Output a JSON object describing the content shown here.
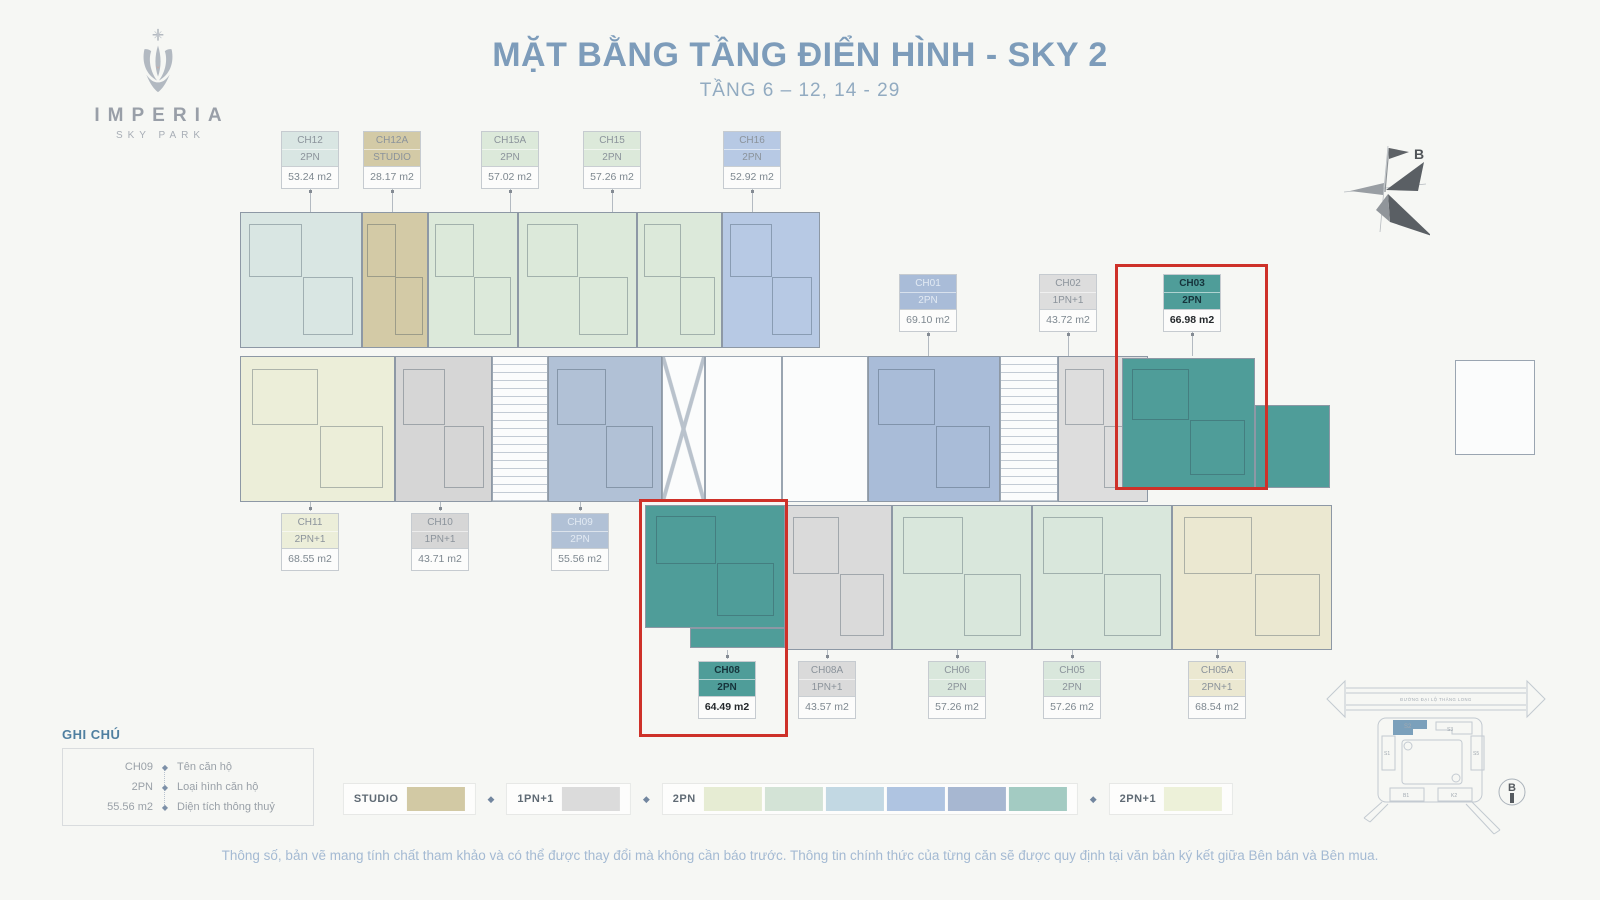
{
  "logo": {
    "title": "IMPERIA",
    "subtitle": "SKY PARK"
  },
  "header": {
    "title": "MẶT BẰNG TẦNG ĐIỂN HÌNH - SKY 2",
    "subtitle": "TẦNG 6 – 12, 14 - 29"
  },
  "compass": {
    "label": "B"
  },
  "units": [
    {
      "id": "CH12",
      "type": "2PN",
      "area": "53.24 m2",
      "color": "#d9e6e3",
      "scheme": "grey",
      "highlight": false
    },
    {
      "id": "CH12A",
      "type": "STUDIO",
      "area": "28.17 m2",
      "color": "#d3caa6",
      "scheme": "grey",
      "highlight": false
    },
    {
      "id": "CH15A",
      "type": "2PN",
      "area": "57.02 m2",
      "color": "#dce9da",
      "scheme": "grey",
      "highlight": false
    },
    {
      "id": "CH15",
      "type": "2PN",
      "area": "57.26 m2",
      "color": "#dce9da",
      "scheme": "grey",
      "highlight": false
    },
    {
      "id": "CH16",
      "type": "2PN",
      "area": "52.92 m2",
      "color": "#b7c9e4",
      "scheme": "grey",
      "highlight": false
    },
    {
      "id": "CH01",
      "type": "2PN",
      "area": "69.10 m2",
      "color": "#a9bcd8",
      "scheme": "light",
      "highlight": false
    },
    {
      "id": "CH02",
      "type": "1PN+1",
      "area": "43.72 m2",
      "color": "#dddddd",
      "scheme": "grey",
      "highlight": false
    },
    {
      "id": "CH03",
      "type": "2PN",
      "area": "66.98 m2",
      "color": "#4f9d99",
      "scheme": "dark",
      "highlight": true
    },
    {
      "id": "CH11",
      "type": "2PN+1",
      "area": "68.55 m2",
      "color": "#eceed9",
      "scheme": "grey",
      "highlight": false
    },
    {
      "id": "CH10",
      "type": "1PN+1",
      "area": "43.71 m2",
      "color": "#d6d6d6",
      "scheme": "grey",
      "highlight": false
    },
    {
      "id": "CH09",
      "type": "2PN",
      "area": "55.56 m2",
      "color": "#b1c1d6",
      "scheme": "light",
      "highlight": false
    },
    {
      "id": "CH08",
      "type": "2PN",
      "area": "64.49 m2",
      "color": "#4f9d99",
      "scheme": "dark",
      "highlight": true
    },
    {
      "id": "CH08A",
      "type": "1PN+1",
      "area": "43.57 m2",
      "color": "#dadada",
      "scheme": "grey",
      "highlight": false
    },
    {
      "id": "CH06",
      "type": "2PN",
      "area": "57.26 m2",
      "color": "#d9e7dc",
      "scheme": "grey",
      "highlight": false
    },
    {
      "id": "CH05",
      "type": "2PN",
      "area": "57.26 m2",
      "color": "#d9e7dc",
      "scheme": "grey",
      "highlight": false
    },
    {
      "id": "CH05A",
      "type": "2PN+1",
      "area": "68.54 m2",
      "color": "#ebe8d1",
      "scheme": "grey",
      "highlight": false
    }
  ],
  "notes_legend": {
    "title": "GHI CHÚ",
    "rows": [
      {
        "key": "CH09",
        "value": "Tên căn hộ"
      },
      {
        "key": "2PN",
        "value": "Loại hình căn hộ"
      },
      {
        "key": "55.56 m2",
        "value": "Diện tích thông thuỷ"
      }
    ]
  },
  "type_legend": {
    "items": [
      {
        "label": "STUDIO",
        "swatches": [
          "#d2c9a4"
        ]
      },
      {
        "label": "1PN+1",
        "swatches": [
          "#dbdbdb"
        ]
      },
      {
        "label": "2PN",
        "swatches": [
          "#e6ecd3",
          "#d3e3d6",
          "#c2d8e3",
          "#afc4e1",
          "#a7b7d1",
          "#a3cbc2"
        ]
      },
      {
        "label": "2PN+1",
        "swatches": [
          "#edf1d9"
        ]
      }
    ]
  },
  "site_map": {
    "road_label": "ĐƯỜNG ĐẠI LỘ THĂNG LONG",
    "highlighted_building": "S2",
    "north_label": "B",
    "building_labels": {
      "s1": "S1",
      "s3": "S3",
      "s5": "S5",
      "b1": "B1",
      "k2": "K2"
    }
  },
  "footer": {
    "disclaimer": "Thông số, bản vẽ mang tính chất tham khảo và có thể được thay đổi mà không cần báo trước. Thông tin chính thức của từng căn sẽ được quy định tại văn bản ký kết giữa Bên bán và Bên mua."
  }
}
